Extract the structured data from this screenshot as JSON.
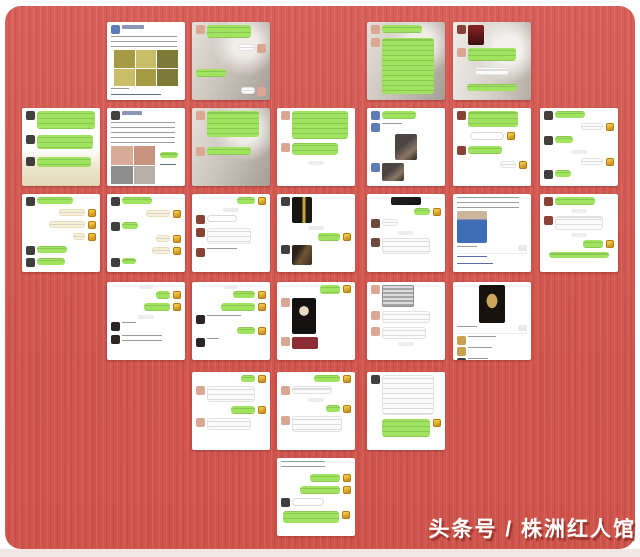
{
  "watermark": {
    "text": "头条号 / 株洲红人馆",
    "color": "#ffffff",
    "shadow": "#8e2e28"
  },
  "background": {
    "page": "#ffffff",
    "card_red": "#d35a51",
    "card_texture_light": "#d9605a",
    "card_texture_dark": "#cf544b",
    "bottom_strip": "#f2e6e3"
  },
  "colors": {
    "bubble_green": "#9fe35f",
    "bubble_white": "#fbfbfb",
    "bubble_pale": "#f7f0dc",
    "sticker_gold": "#e6b83c",
    "timestamp_pill": "#ededed",
    "link_blue": "#5d6e9e"
  },
  "palette": {
    "dk": "#413f3d",
    "pk": "#d9a794",
    "bl": "#5d7cb8",
    "rd": "#8a4136",
    "gd": "#caa14e",
    "bw": "#6b4a3f",
    "dx": "#2f2425"
  },
  "grid": {
    "cols": [
      22,
      107,
      192,
      277,
      367,
      453,
      540
    ],
    "rows": [
      22,
      108,
      194,
      282,
      372,
      458
    ],
    "tile_w": 78,
    "tile_h": 78
  },
  "tiles": [
    {
      "id": "r1c2",
      "col": 1,
      "row": 0,
      "bg": "white",
      "rows": [
        {
          "k": "name",
          "av": "bl",
          "w": 22,
          "h": 4
        },
        {
          "k": "text",
          "s": "l",
          "w": 66,
          "h": 12,
          "g": 2
        },
        {
          "k": "grid",
          "s": "c",
          "w": 64,
          "h": 36,
          "c": "olive",
          "cols": 3,
          "cells": 6,
          "g": 2
        },
        {
          "k": "text",
          "s": "l",
          "w": 18,
          "h": 4,
          "g": 2
        },
        {
          "k": "link",
          "s": "l",
          "w": 50,
          "h": 5,
          "g": 2
        }
      ]
    },
    {
      "id": "r1c3",
      "col": 2,
      "row": 0,
      "bg": "portrait",
      "rows": [
        {
          "k": "bub-g",
          "s": "l",
          "av": "pk",
          "w": 44,
          "h": 13
        },
        {
          "k": "bub-w",
          "s": "r",
          "av": "pk",
          "w": 16,
          "h": 7,
          "g": 6
        },
        {
          "k": "bub-g",
          "s": "l",
          "w": 30,
          "h": 8,
          "g": 16
        },
        {
          "k": "bub-w",
          "s": "r",
          "av": "pk",
          "w": 14,
          "h": 7,
          "g": 10
        }
      ]
    },
    {
      "id": "r1c5",
      "col": 4,
      "row": 0,
      "bg": "portrait",
      "rows": [
        {
          "k": "bub-g",
          "s": "l",
          "av": "pk",
          "w": 40,
          "h": 8
        },
        {
          "k": "bub-g",
          "s": "l",
          "av": "pk",
          "w": 52,
          "h": 56,
          "g": 4
        }
      ]
    },
    {
      "id": "r1c6",
      "col": 5,
      "row": 0,
      "bg": "portrait2",
      "rows": [
        {
          "k": "photo",
          "s": "l",
          "av": "rd",
          "w": 16,
          "h": 20,
          "c": "red"
        },
        {
          "k": "bub-g",
          "s": "l",
          "av": "pk",
          "w": 48,
          "h": 13,
          "g": 3
        },
        {
          "k": "bub-w",
          "s": "c",
          "w": 34,
          "h": 8,
          "g": 6
        },
        {
          "k": "bub-g",
          "s": "c",
          "w": 50,
          "h": 7,
          "g": 9
        }
      ]
    },
    {
      "id": "r2c1",
      "col": 0,
      "row": 1,
      "bg": "products",
      "rows": [
        {
          "k": "bub-g",
          "s": "l",
          "av": "dk",
          "w": 58,
          "h": 18
        },
        {
          "k": "bub-g",
          "s": "l",
          "av": "dk",
          "w": 56,
          "h": 14,
          "g": 6
        },
        {
          "k": "bub-g",
          "s": "l",
          "av": "dk",
          "w": 54,
          "h": 10,
          "g": 8
        }
      ]
    },
    {
      "id": "r2c2",
      "col": 1,
      "row": 1,
      "bg": "white",
      "rows": [
        {
          "k": "name",
          "av": "dk",
          "w": 20,
          "h": 4
        },
        {
          "k": "text",
          "s": "l",
          "w": 64,
          "h": 22,
          "g": 2
        },
        {
          "k": "grid",
          "s": "l",
          "w": 44,
          "h": 38,
          "c": "skin",
          "cols": 2,
          "cells": 4,
          "g": 2,
          "side": {
            "w": 18,
            "h": 6
          }
        }
      ]
    },
    {
      "id": "r2c3",
      "col": 2,
      "row": 1,
      "bg": "portrait",
      "rows": [
        {
          "k": "bub-g",
          "s": "l",
          "av": "pk",
          "w": 52,
          "h": 26
        },
        {
          "k": "bub-g",
          "s": "l",
          "av": "pk",
          "w": 44,
          "h": 8,
          "g": 10
        }
      ]
    },
    {
      "id": "r2c4",
      "col": 3,
      "row": 1,
      "bg": "white",
      "rows": [
        {
          "k": "bub-g",
          "s": "l",
          "av": "pk",
          "w": 56,
          "h": 28
        },
        {
          "k": "bub-g",
          "s": "l",
          "av": "pk",
          "w": 46,
          "h": 12,
          "g": 4
        },
        {
          "k": "pill",
          "s": "c",
          "w": 16,
          "h": 4,
          "g": 6
        }
      ]
    },
    {
      "id": "r2c5",
      "col": 4,
      "row": 1,
      "bg": "white",
      "rows": [
        {
          "k": "bub-g",
          "s": "l",
          "av": "bl",
          "w": 34,
          "h": 8
        },
        {
          "k": "text",
          "s": "l",
          "av": "bl",
          "w": 20,
          "h": 5,
          "g": 3
        },
        {
          "k": "photo",
          "s": "c",
          "w": 22,
          "h": 26,
          "c": "portrait",
          "g": 2
        },
        {
          "k": "photo",
          "s": "l",
          "av": "bl",
          "w": 22,
          "h": 18,
          "c": "portrait",
          "g": 3
        }
      ]
    },
    {
      "id": "r2c6",
      "col": 5,
      "row": 1,
      "bg": "white",
      "rows": [
        {
          "k": "bub-g",
          "s": "l",
          "av": "rd",
          "w": 50,
          "h": 16
        },
        {
          "k": "input",
          "s": "c",
          "w": 34,
          "h": 8,
          "ic": true,
          "g": 5
        },
        {
          "k": "bub-g",
          "s": "l",
          "av": "rd",
          "w": 34,
          "h": 8,
          "g": 6
        },
        {
          "k": "bub-w",
          "s": "r",
          "w": 16,
          "h": 7,
          "ic": true,
          "g": 6
        }
      ]
    },
    {
      "id": "r2c7",
      "col": 6,
      "row": 1,
      "bg": "white",
      "rows": [
        {
          "k": "bub-g",
          "s": "l",
          "av": "dk",
          "w": 30,
          "h": 7
        },
        {
          "k": "bub-w",
          "s": "r",
          "w": 22,
          "h": 7,
          "ic": true,
          "g": 3
        },
        {
          "k": "bub-g",
          "s": "l",
          "av": "dk",
          "w": 18,
          "h": 7,
          "g": 5
        },
        {
          "k": "pill",
          "s": "c",
          "w": 16,
          "h": 4,
          "g": 5
        },
        {
          "k": "bub-w",
          "s": "r",
          "w": 22,
          "h": 7,
          "ic": true,
          "g": 4
        },
        {
          "k": "bub-g",
          "s": "l",
          "av": "dk",
          "w": 16,
          "h": 7,
          "g": 4
        }
      ]
    },
    {
      "id": "r3c1",
      "col": 0,
      "row": 2,
      "bg": "white",
      "rows": [
        {
          "k": "bub-g",
          "s": "l",
          "av": "dk",
          "w": 36,
          "h": 7
        },
        {
          "k": "bub-p",
          "s": "r",
          "w": 26,
          "h": 7,
          "ic": true,
          "g": 3
        },
        {
          "k": "bub-p",
          "s": "r",
          "w": 36,
          "h": 7,
          "ic": true,
          "g": 4
        },
        {
          "k": "bub-p",
          "s": "r",
          "w": 12,
          "h": 7,
          "ic": true,
          "g": 4
        },
        {
          "k": "bub-g",
          "s": "l",
          "av": "dk",
          "w": 30,
          "h": 7,
          "g": 5
        },
        {
          "k": "bub-g",
          "s": "l",
          "av": "dk",
          "w": 28,
          "h": 7,
          "g": 3
        }
      ]
    },
    {
      "id": "r3c2",
      "col": 1,
      "row": 2,
      "bg": "white",
      "rows": [
        {
          "k": "bub-g",
          "s": "l",
          "av": "dk",
          "w": 30,
          "h": 7
        },
        {
          "k": "bub-p",
          "s": "r",
          "w": 24,
          "h": 7,
          "ic": true,
          "g": 4
        },
        {
          "k": "bub-g",
          "s": "l",
          "av": "dk",
          "w": 16,
          "h": 7,
          "g": 4
        },
        {
          "k": "bub-p",
          "s": "r",
          "w": 14,
          "h": 7,
          "ic": true,
          "g": 4
        },
        {
          "k": "bub-p",
          "s": "r",
          "w": 18,
          "h": 7,
          "ic": true,
          "g": 4
        },
        {
          "k": "bub-g",
          "s": "l",
          "av": "dk",
          "w": 14,
          "h": 6,
          "g": 3
        }
      ]
    },
    {
      "id": "r3c3",
      "col": 2,
      "row": 2,
      "bg": "white",
      "rows": [
        {
          "k": "bub-g",
          "s": "r",
          "w": 18,
          "h": 7,
          "ic": true
        },
        {
          "k": "pill",
          "s": "c",
          "w": 16,
          "h": 4,
          "g": 3
        },
        {
          "k": "input",
          "s": "l",
          "av": "rd",
          "w": 30,
          "h": 7,
          "g": 3
        },
        {
          "k": "bub-w",
          "s": "l",
          "av": "rd",
          "w": 44,
          "h": 16,
          "g": 4
        },
        {
          "k": "text",
          "s": "l",
          "av": "rd",
          "w": 30,
          "h": 5,
          "g": 4
        }
      ]
    },
    {
      "id": "r3c4",
      "col": 3,
      "row": 2,
      "bg": "white",
      "rows": [
        {
          "k": "photo",
          "s": "l",
          "av": "dk",
          "w": 20,
          "h": 26,
          "c": "bottles"
        },
        {
          "k": "pill",
          "s": "c",
          "w": 16,
          "h": 4,
          "g": 3
        },
        {
          "k": "bub-g",
          "s": "r",
          "w": 22,
          "h": 8,
          "ic": true,
          "g": 3
        },
        {
          "k": "photo",
          "s": "l",
          "av": "dk",
          "w": 20,
          "h": 20,
          "c": "street",
          "g": 4
        }
      ]
    },
    {
      "id": "r3c5",
      "col": 4,
      "row": 2,
      "bg": "white",
      "rows": [
        {
          "k": "photo",
          "s": "c",
          "w": 30,
          "h": 8,
          "c": "dark"
        },
        {
          "k": "bub-g",
          "s": "r",
          "w": 16,
          "h": 7,
          "ic": true,
          "g": 3
        },
        {
          "k": "bub-w",
          "s": "l",
          "av": "bw",
          "w": 16,
          "h": 7,
          "g": 3
        },
        {
          "k": "pill",
          "s": "c",
          "w": 16,
          "h": 4,
          "g": 3
        },
        {
          "k": "bub-w",
          "s": "l",
          "av": "bw",
          "w": 48,
          "h": 16,
          "g": 3
        }
      ]
    },
    {
      "id": "r3c6",
      "col": 5,
      "row": 2,
      "bg": "white",
      "rows": [
        {
          "k": "text",
          "s": "l",
          "w": 62,
          "h": 12
        },
        {
          "k": "photo",
          "s": "l",
          "w": 30,
          "h": 32,
          "c": "man",
          "g": 2
        },
        {
          "k": "meta",
          "g": 2
        },
        {
          "k": "divider",
          "g": 2
        },
        {
          "k": "link",
          "s": "l",
          "w": 30,
          "h": 5,
          "g": 2
        },
        {
          "k": "link",
          "s": "l",
          "w": 36,
          "h": 5,
          "g": 2
        }
      ]
    },
    {
      "id": "r3c7",
      "col": 6,
      "row": 2,
      "bg": "white",
      "rows": [
        {
          "k": "bub-g",
          "s": "l",
          "av": "rd",
          "w": 40,
          "h": 8
        },
        {
          "k": "pill",
          "s": "c",
          "w": 16,
          "h": 4,
          "g": 3
        },
        {
          "k": "bub-w",
          "s": "l",
          "av": "rd",
          "w": 48,
          "h": 14,
          "g": 3
        },
        {
          "k": "pill",
          "s": "c",
          "w": 16,
          "h": 4,
          "g": 3
        },
        {
          "k": "bub-g",
          "s": "r",
          "w": 20,
          "h": 8,
          "ic": true,
          "g": 3
        },
        {
          "k": "bub-g",
          "s": "c",
          "w": 60,
          "h": 6,
          "g": 4
        }
      ]
    },
    {
      "id": "r4c2",
      "col": 1,
      "row": 3,
      "bg": "white",
      "rows": [
        {
          "k": "pill",
          "s": "c",
          "w": 14,
          "h": 4
        },
        {
          "k": "bub-g",
          "s": "r",
          "w": 14,
          "h": 8,
          "ic": true,
          "g": 2
        },
        {
          "k": "bub-g",
          "s": "r",
          "w": 26,
          "h": 8,
          "ic": true,
          "g": 4
        },
        {
          "k": "pill",
          "s": "c",
          "w": 16,
          "h": 4,
          "g": 4
        },
        {
          "k": "text",
          "s": "l",
          "av": "dx",
          "w": 14,
          "h": 5,
          "g": 3
        },
        {
          "k": "text",
          "s": "l",
          "av": "dx",
          "w": 40,
          "h": 9,
          "g": 4
        }
      ]
    },
    {
      "id": "r4c3",
      "col": 2,
      "row": 3,
      "bg": "white",
      "rows": [
        {
          "k": "pill",
          "s": "c",
          "w": 14,
          "h": 4
        },
        {
          "k": "bub-g",
          "s": "r",
          "w": 22,
          "h": 7,
          "ic": true,
          "g": 2
        },
        {
          "k": "bub-g",
          "s": "r",
          "w": 34,
          "h": 8,
          "ic": true,
          "g": 4
        },
        {
          "k": "text",
          "s": "l",
          "av": "dx",
          "w": 34,
          "h": 5,
          "g": 4
        },
        {
          "k": "bub-g",
          "s": "r",
          "w": 18,
          "h": 7,
          "ic": true,
          "g": 3
        },
        {
          "k": "text",
          "s": "l",
          "av": "dx",
          "w": 12,
          "h": 5,
          "g": 3
        }
      ]
    },
    {
      "id": "r4c4",
      "col": 3,
      "row": 3,
      "bg": "white",
      "rows": [
        {
          "k": "bub-g",
          "s": "r",
          "w": 20,
          "h": 9,
          "ic": true
        },
        {
          "k": "photo",
          "s": "l",
          "av": "pk",
          "w": 24,
          "h": 36,
          "c": "darkface",
          "g": 4
        },
        {
          "k": "photo",
          "s": "l",
          "av": "pk",
          "w": 26,
          "h": 12,
          "c": "redcard",
          "g": 3
        }
      ]
    },
    {
      "id": "r4c5",
      "col": 4,
      "row": 3,
      "bg": "white",
      "rows": [
        {
          "k": "photo",
          "s": "l",
          "av": "pk",
          "w": 32,
          "h": 22,
          "c": "silver"
        },
        {
          "k": "bub-w",
          "s": "l",
          "av": "pk",
          "w": 48,
          "h": 12,
          "g": 4
        },
        {
          "k": "bub-w",
          "s": "l",
          "av": "pk",
          "w": 44,
          "h": 12,
          "g": 4
        },
        {
          "k": "pill",
          "s": "c",
          "w": 16,
          "h": 4,
          "g": 3
        }
      ]
    },
    {
      "id": "r4c6",
      "col": 5,
      "row": 3,
      "bg": "white",
      "rows": [
        {
          "k": "photo",
          "s": "c",
          "w": 26,
          "h": 38,
          "c": "darkgold"
        },
        {
          "k": "meta",
          "g": 2
        },
        {
          "k": "divider",
          "g": 2
        },
        {
          "k": "text",
          "s": "l",
          "av": "gd",
          "w": 28,
          "h": 5,
          "g": 2
        },
        {
          "k": "text",
          "s": "l",
          "av": "gd",
          "w": 24,
          "h": 5,
          "g": 2
        },
        {
          "k": "text",
          "s": "l",
          "av": "dk",
          "w": 20,
          "h": 5,
          "g": 2
        }
      ]
    },
    {
      "id": "r5c3",
      "col": 2,
      "row": 4,
      "bg": "white",
      "rows": [
        {
          "k": "bub-g",
          "s": "r",
          "w": 14,
          "h": 7,
          "ic": true
        },
        {
          "k": "bub-w",
          "s": "l",
          "av": "pk",
          "w": 48,
          "h": 16,
          "g": 3
        },
        {
          "k": "bub-g",
          "s": "r",
          "w": 24,
          "h": 8,
          "ic": true,
          "g": 4
        },
        {
          "k": "bub-w",
          "s": "l",
          "av": "pk",
          "w": 44,
          "h": 12,
          "g": 4
        }
      ]
    },
    {
      "id": "r5c4",
      "col": 3,
      "row": 4,
      "bg": "white",
      "rows": [
        {
          "k": "bub-g",
          "s": "r",
          "w": 26,
          "h": 7,
          "ic": true
        },
        {
          "k": "bub-w",
          "s": "l",
          "av": "pk",
          "w": 40,
          "h": 8,
          "g": 3
        },
        {
          "k": "pill",
          "s": "c",
          "w": 16,
          "h": 4,
          "g": 3
        },
        {
          "k": "bub-g",
          "s": "r",
          "w": 14,
          "h": 7,
          "ic": true,
          "g": 3
        },
        {
          "k": "bub-w",
          "s": "l",
          "av": "pk",
          "w": 50,
          "h": 16,
          "g": 3
        }
      ]
    },
    {
      "id": "r5c5",
      "col": 4,
      "row": 4,
      "bg": "white",
      "rows": [
        {
          "k": "bub-w",
          "s": "l",
          "av": "dk",
          "w": 52,
          "h": 40
        },
        {
          "k": "bub-g",
          "s": "r",
          "w": 48,
          "h": 18,
          "ic": true,
          "g": 4
        }
      ]
    },
    {
      "id": "r6c4",
      "col": 3,
      "row": 5,
      "bg": "white",
      "rows": [
        {
          "k": "text",
          "s": "l",
          "w": 44,
          "h": 9
        },
        {
          "k": "bub-g",
          "s": "r",
          "w": 30,
          "h": 8,
          "ic": true,
          "g": 4
        },
        {
          "k": "bub-g",
          "s": "r",
          "w": 40,
          "h": 8,
          "ic": true,
          "g": 4
        },
        {
          "k": "input",
          "s": "l",
          "av": "dk",
          "w": 32,
          "h": 8,
          "g": 4
        },
        {
          "k": "bub-g",
          "s": "c",
          "w": 56,
          "h": 12,
          "ic": true,
          "g": 4
        }
      ]
    }
  ]
}
